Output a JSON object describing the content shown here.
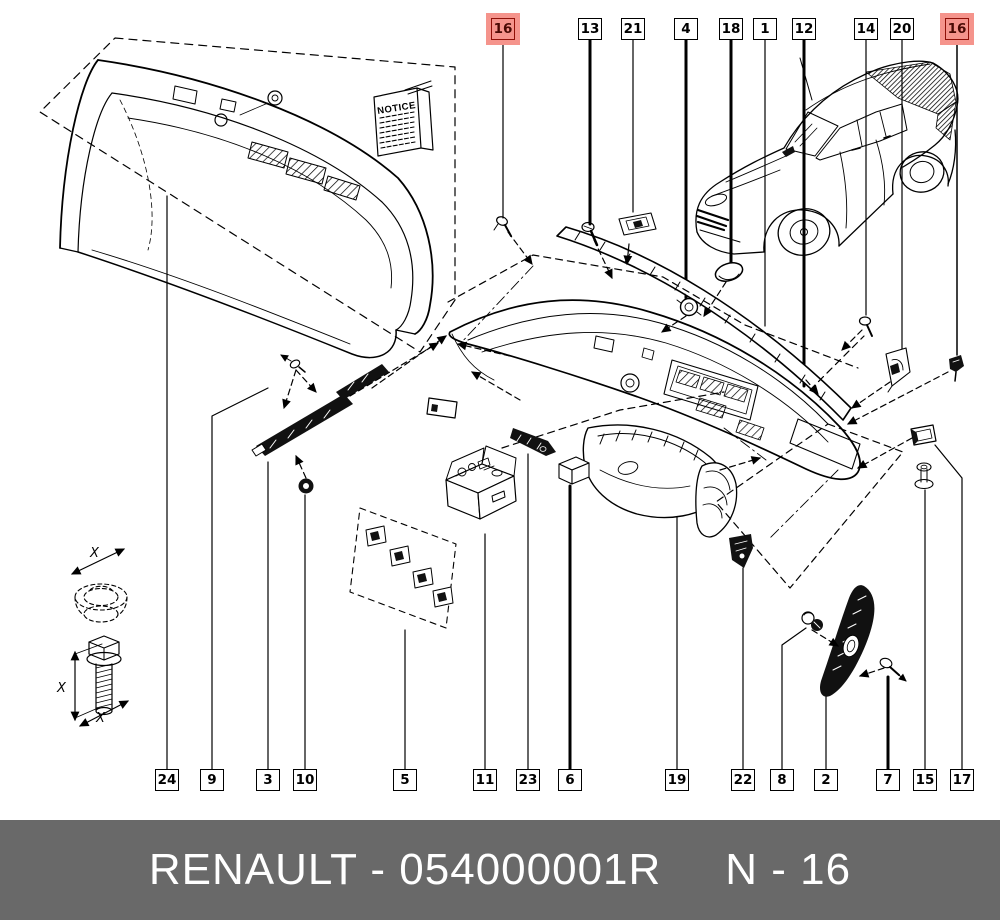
{
  "footer": {
    "left_text": "RENAULT - 054000001R",
    "right_text": "N - 16"
  },
  "notice": {
    "title": "NOTICE"
  },
  "dimension_labels": {
    "spacer": "X",
    "bolt_length": "X",
    "bolt_end": "X"
  },
  "colors": {
    "line": "#000000",
    "background": "#ffffff",
    "highlight_fill": "#f5948c",
    "highlight_border": "#8f1007",
    "highlight_text": "#4a0a04",
    "label_bg": "#ffffff",
    "label_border": "#000000",
    "footer_bg": "#696969",
    "footer_text": "#ffffff"
  },
  "callouts": {
    "top": [
      {
        "number": "16",
        "highlighted": true
      },
      {
        "number": "13",
        "highlighted": false
      },
      {
        "number": "21",
        "highlighted": false
      },
      {
        "number": "4",
        "highlighted": false
      },
      {
        "number": "18",
        "highlighted": false
      },
      {
        "number": "1",
        "highlighted": false
      },
      {
        "number": "12",
        "highlighted": false
      },
      {
        "number": "14",
        "highlighted": false
      },
      {
        "number": "20",
        "highlighted": false
      },
      {
        "number": "16",
        "highlighted": true
      }
    ],
    "bottom": [
      {
        "number": "24",
        "highlighted": false
      },
      {
        "number": "9",
        "highlighted": false
      },
      {
        "number": "3",
        "highlighted": false
      },
      {
        "number": "10",
        "highlighted": false
      },
      {
        "number": "5",
        "highlighted": false
      },
      {
        "number": "11",
        "highlighted": false
      },
      {
        "number": "23",
        "highlighted": false
      },
      {
        "number": "6",
        "highlighted": false
      },
      {
        "number": "19",
        "highlighted": false
      },
      {
        "number": "22",
        "highlighted": false
      },
      {
        "number": "8",
        "highlighted": false
      },
      {
        "number": "2",
        "highlighted": false
      },
      {
        "number": "7",
        "highlighted": false
      },
      {
        "number": "15",
        "highlighted": false
      },
      {
        "number": "17",
        "highlighted": false
      }
    ]
  }
}
